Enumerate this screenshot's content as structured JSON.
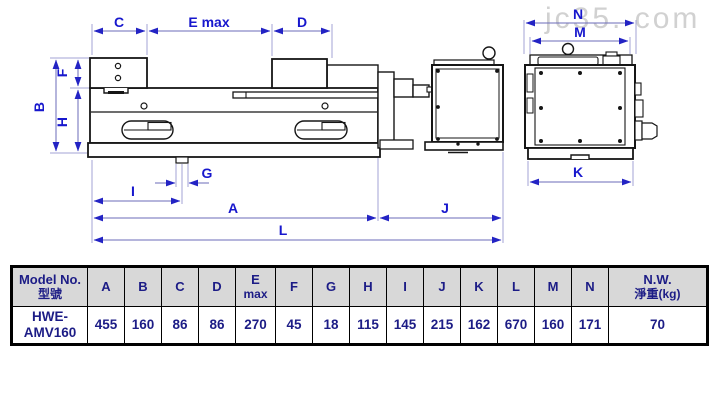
{
  "watermark": "jc35. com",
  "colors": {
    "dimension_line": "#6b6bba",
    "extension_line": "#a3a3d6",
    "arrow": "#2323c4",
    "dimension_label": "#1717cd",
    "table_text": "#1c1c86",
    "table_header_bg": "#d8d8d8",
    "drawing_ink": "#161616",
    "watermark_gray": "#c9c9c9"
  },
  "drawing": {
    "dim_labels": {
      "C": "C",
      "E": "E max",
      "D": "D",
      "F": "F",
      "B": "B",
      "H": "H",
      "G": "G",
      "I": "I",
      "A": "A",
      "L": "L",
      "J": "J",
      "K": "K",
      "M": "M",
      "N": "N"
    }
  },
  "table": {
    "columns": [
      {
        "label": "Model No.",
        "sub": "型號"
      },
      {
        "label": "A"
      },
      {
        "label": "B"
      },
      {
        "label": "C"
      },
      {
        "label": "D"
      },
      {
        "label": "E",
        "sub": "max"
      },
      {
        "label": "F"
      },
      {
        "label": "G"
      },
      {
        "label": "H"
      },
      {
        "label": "I"
      },
      {
        "label": "J"
      },
      {
        "label": "K"
      },
      {
        "label": "L"
      },
      {
        "label": "M"
      },
      {
        "label": "N"
      },
      {
        "label": "N.W.",
        "sub": "淨重(kg)"
      }
    ],
    "row": {
      "model_line1": "HWE-",
      "model_line2": "AMV160",
      "values": [
        "455",
        "160",
        "86",
        "86",
        "270",
        "45",
        "18",
        "115",
        "145",
        "215",
        "162",
        "670",
        "160",
        "171",
        "70"
      ]
    }
  }
}
